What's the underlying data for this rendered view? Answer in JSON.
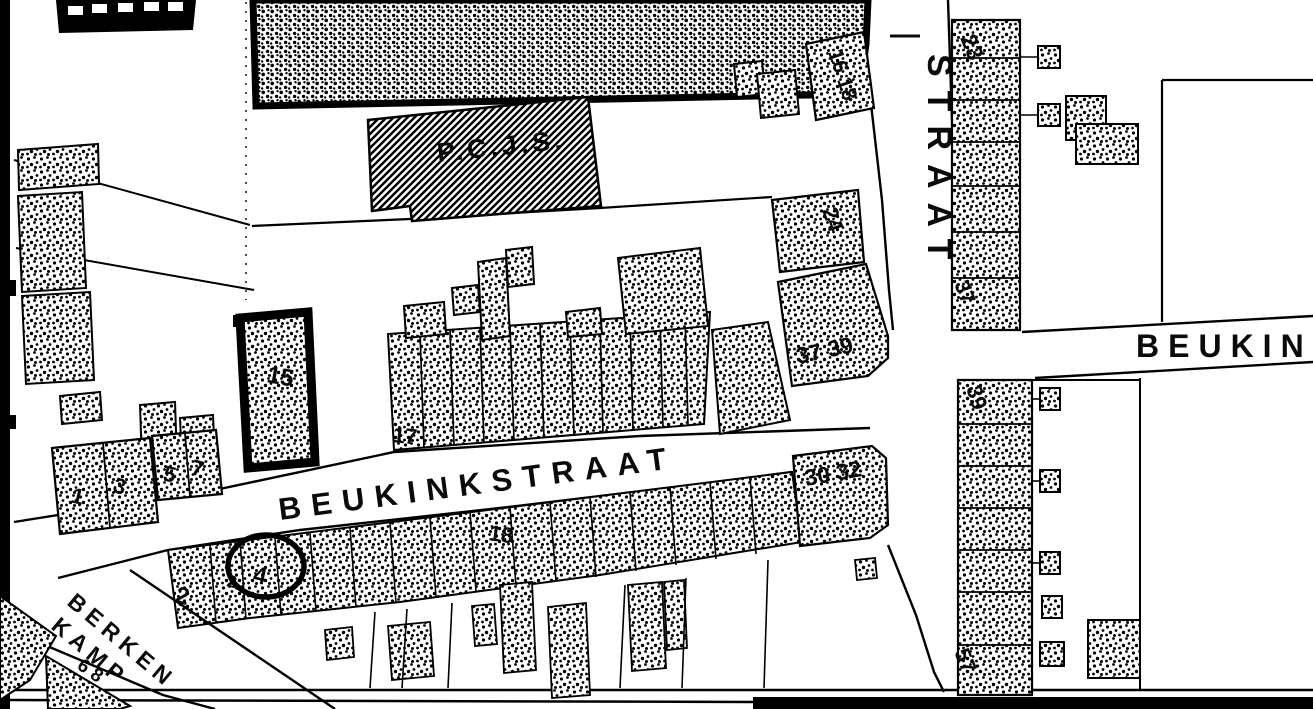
{
  "streets": {
    "beukinkstraat": "BEUKINKSTRAAT",
    "straat_vertical": "STRAAT",
    "straat_dash": "—",
    "beukink_partial": "BEUKINK",
    "berken": "BERKEN",
    "kamp": "KAMP"
  },
  "buildings": {
    "pcjs": "P.C.J.S."
  },
  "house_numbers": {
    "left_row": {
      "h1": "1",
      "h3": "3",
      "h5": "5",
      "h7": "7"
    },
    "bold_building": "15",
    "mid": "17",
    "south": "18",
    "south_left": {
      "a": "2",
      "b": "2",
      "circled": "4"
    },
    "berkenkamp": "6 8",
    "east": {
      "n16_18": "16 18",
      "n24": "24",
      "n37_39": "37 39",
      "n30_32": "30 32"
    },
    "right_top": {
      "n23": "23",
      "n37": "37"
    },
    "right_bottom": {
      "n39": "39",
      "n57": "57"
    }
  },
  "annotation": {
    "circled_number": "4",
    "shape": "hand-drawn ellipse"
  },
  "colors": {
    "ink": "#000000",
    "paper": "#ffffff"
  }
}
